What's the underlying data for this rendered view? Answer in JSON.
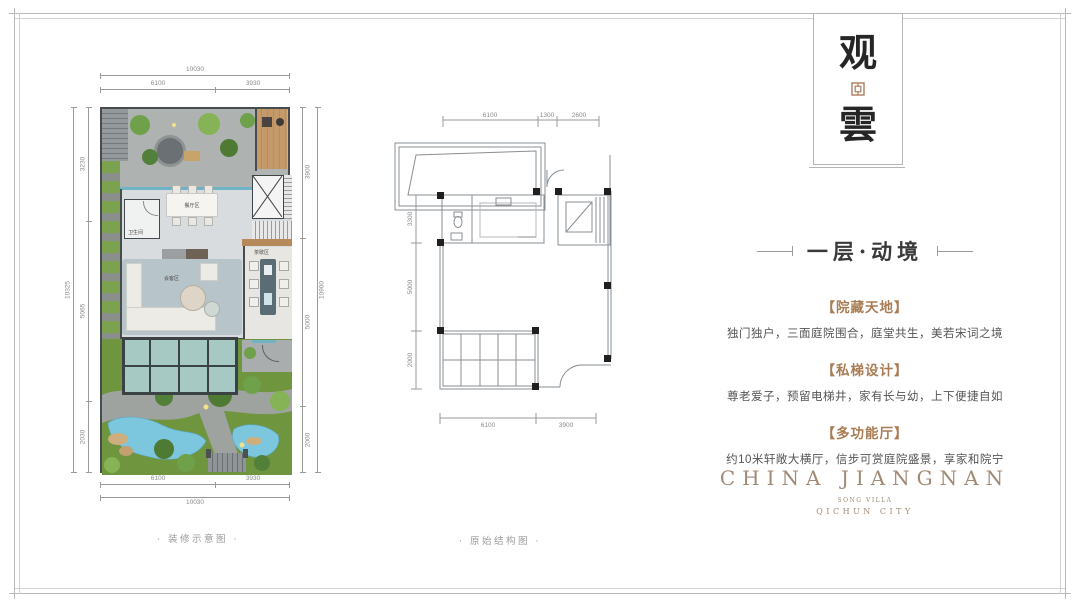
{
  "page": {
    "captions": {
      "left": "· 装修示意图 ·",
      "right": "· 原始结构图 ·"
    }
  },
  "banner": {
    "char_top": "观",
    "char_bottom": "雲"
  },
  "right_panel": {
    "title": "一层·动境",
    "sections": [
      {
        "heading": "【院藏天地】",
        "body": "独门独户，三面庭院围合，庭堂共生，美若宋词之境"
      },
      {
        "heading": "【私梯设计】",
        "body": "尊老爱子，预留电梯井，家有长与幼，上下便捷自如"
      },
      {
        "heading": "【多功能厅】",
        "body": "约10米轩敞大横厅，信步可赏庭院盛景，享家和院宁"
      }
    ],
    "logo": {
      "main": "CHINA JIANGNAN",
      "sub1": "SONG VILLA",
      "sub2": "QICHUN CITY"
    }
  },
  "left_plan": {
    "dim_top_total": "10030",
    "dim_top_a": "6100",
    "dim_top_b": "3930",
    "dim_bottom_total": "10030",
    "dim_bottom_a": "6100",
    "dim_bottom_b": "3930",
    "dim_left_total": "10325",
    "dim_left_a": "3230",
    "dim_left_b": "5065",
    "dim_left_c": "2030",
    "dim_right_total": "10900",
    "dim_right_a": "3900",
    "dim_right_b": "5000",
    "dim_right_c": "2000",
    "label_dining": "餐厅区",
    "label_living": "会客区",
    "label_tea": "茶歇区",
    "label_bath": "卫生间"
  },
  "middle_plan": {
    "dim_top_a": "6100",
    "dim_top_b": "1300",
    "dim_top_c": "2600",
    "dim_bottom_a": "6100",
    "dim_bottom_b": "3900",
    "dim_left_a": "3300",
    "dim_left_b": "5000",
    "dim_left_c": "2000"
  },
  "colors": {
    "accent_brown": "#a97c54",
    "logo_brown": "#a18a75",
    "water_blue": "#7cc7de",
    "glass_teal": "#a6c9c3",
    "wood_deck": "#c59a6a",
    "garden_green": "#70953f"
  }
}
